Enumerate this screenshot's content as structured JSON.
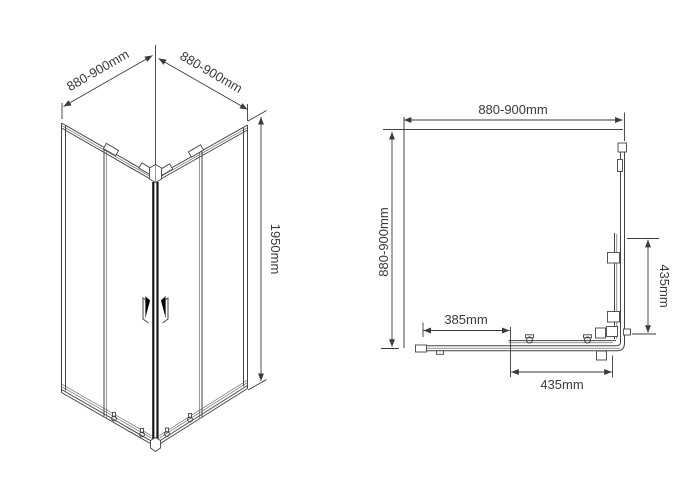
{
  "drawing": {
    "isometric": {
      "dim_width_left": "880-900mm",
      "dim_width_right": "880-900mm",
      "dim_height": "1950mm"
    },
    "plan": {
      "dim_width_top": "880-900mm",
      "dim_depth_left": "880-900mm",
      "dim_fixed_panel": "385mm",
      "dim_door_bottom": "435mm",
      "dim_door_right": "435mm"
    },
    "colors": {
      "line": "#444444",
      "dark_frame": "#171717",
      "text": "#3a3a3a",
      "background": "#ffffff"
    }
  }
}
